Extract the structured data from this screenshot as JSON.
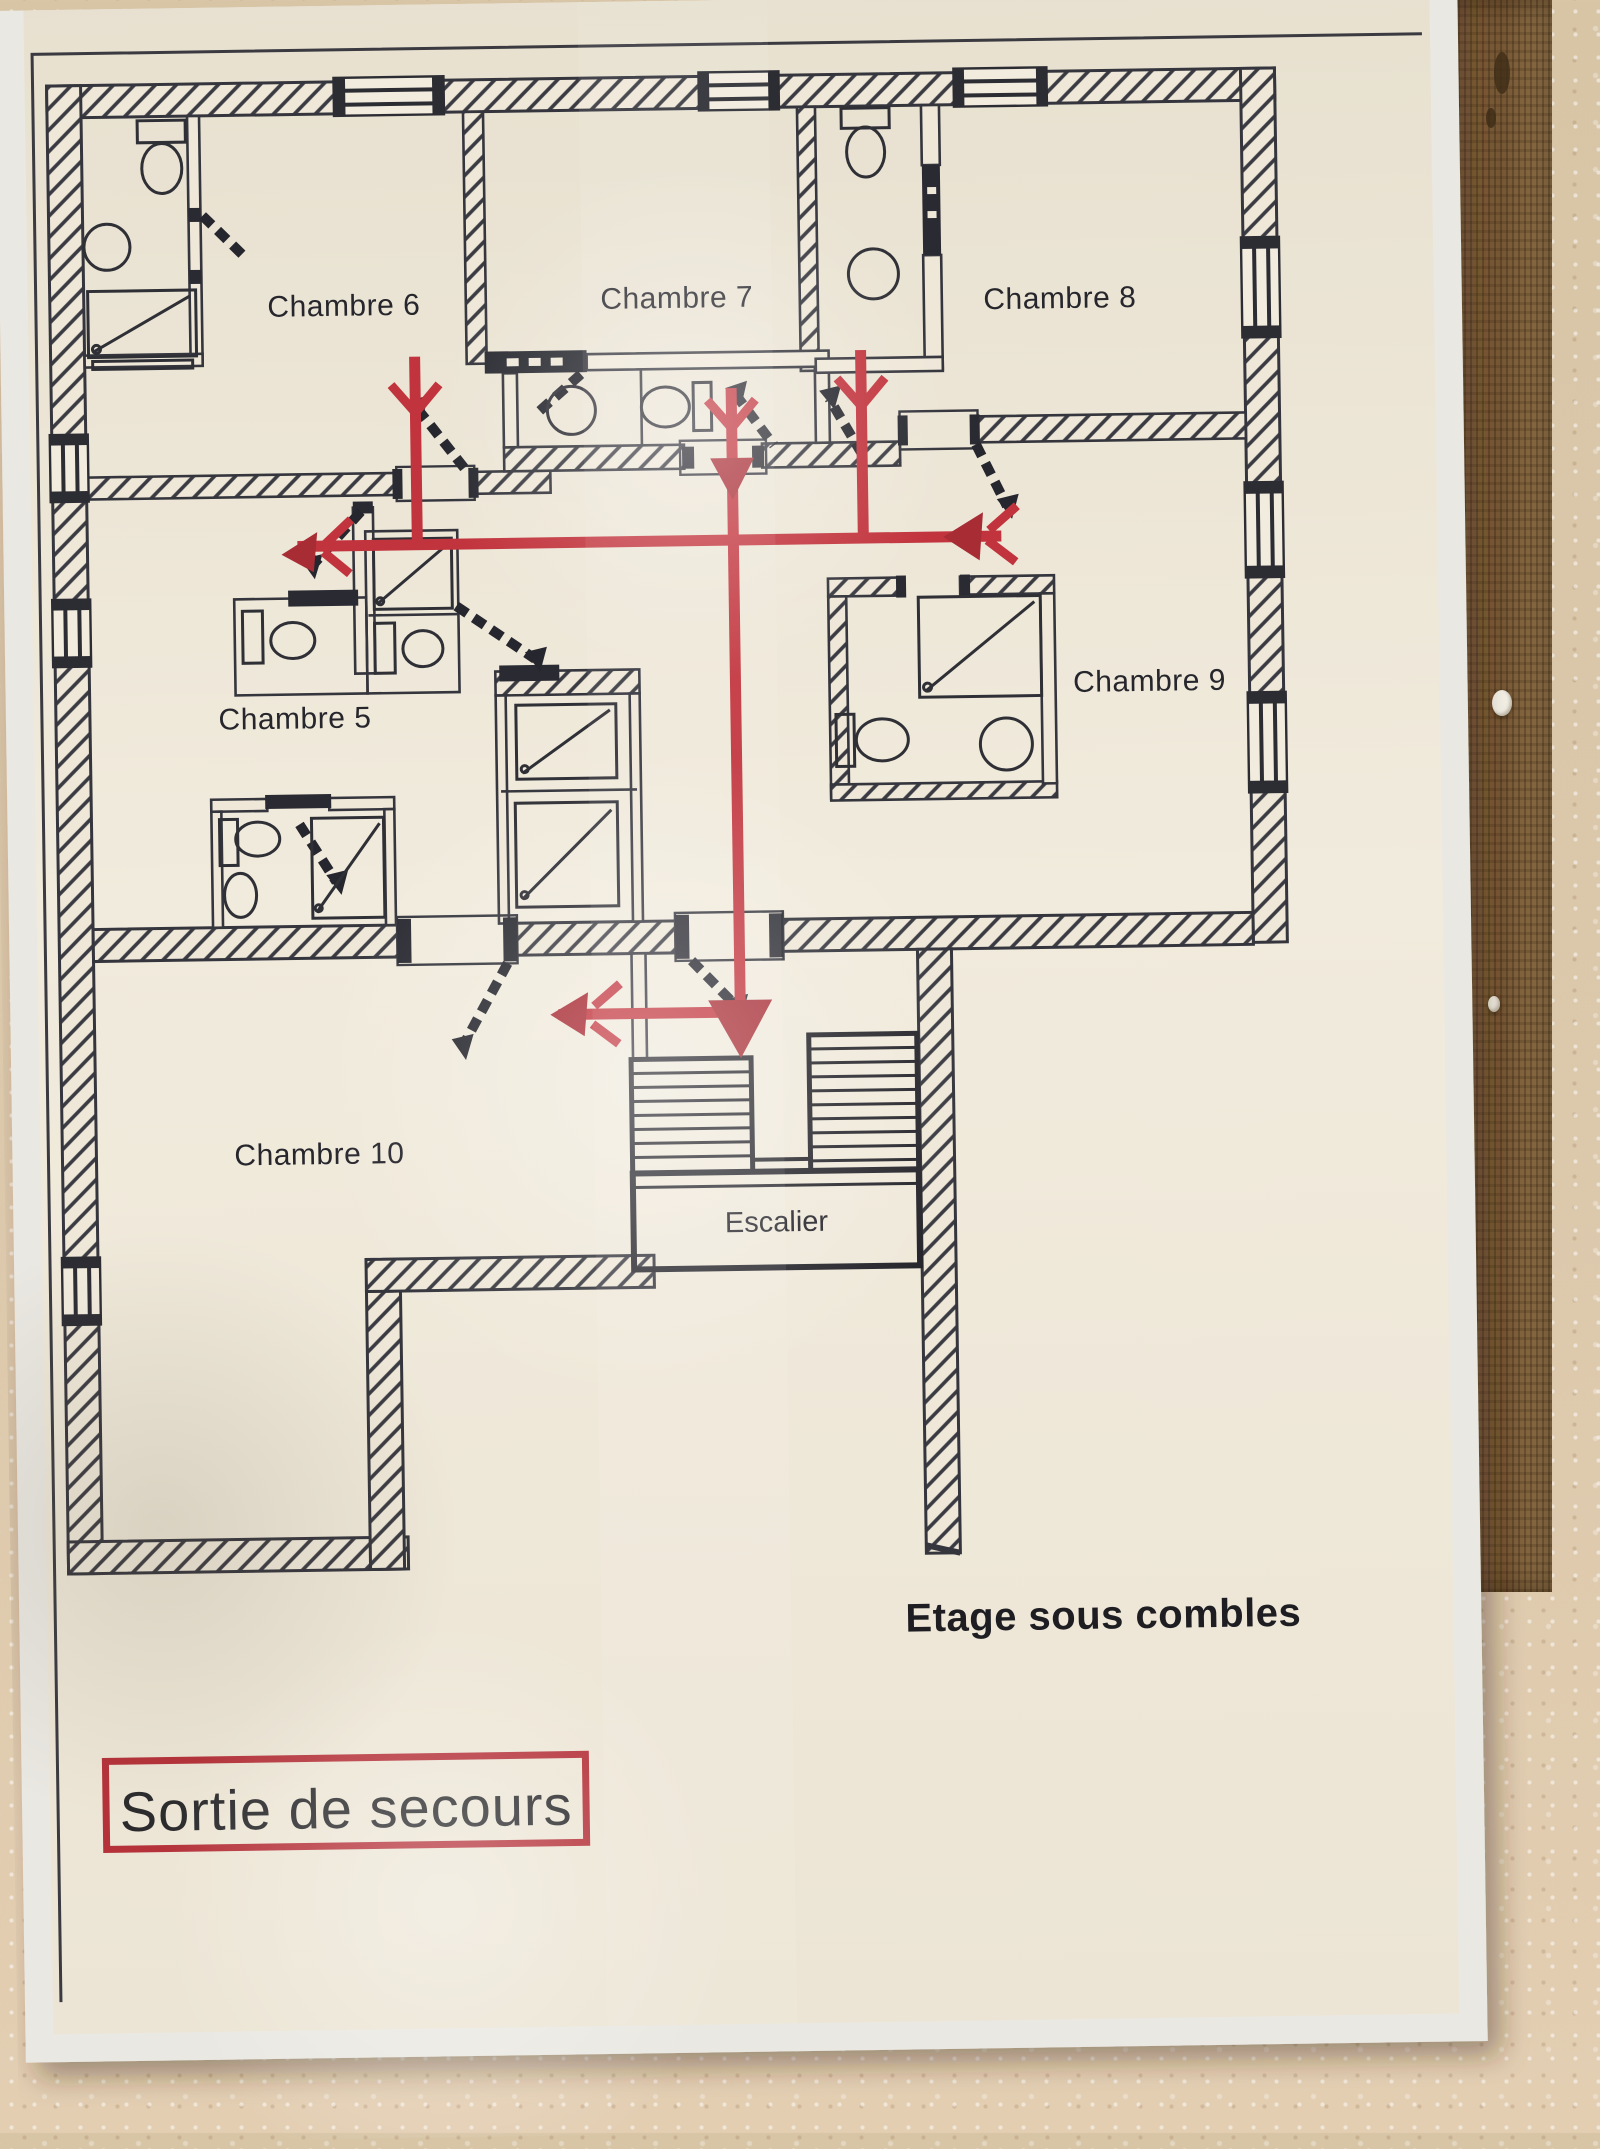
{
  "poster": {
    "rooms": [
      {
        "id": "chambre-6",
        "label": "Chambre 6"
      },
      {
        "id": "chambre-7",
        "label": "Chambre 7"
      },
      {
        "id": "chambre-8",
        "label": "Chambre 8"
      },
      {
        "id": "chambre-5",
        "label": "Chambre 5"
      },
      {
        "id": "chambre-9",
        "label": "Chambre 9"
      },
      {
        "id": "chambre-10",
        "label": "Chambre 10"
      }
    ],
    "stairs": {
      "label": "Escalier"
    },
    "captions": {
      "floor": "Etage sous combles"
    },
    "legend": {
      "label": "Sortie de secours"
    },
    "colors": {
      "escape_route": "#c2343d",
      "escape_route_dark": "#a82c34",
      "legend_border": "#b5323a",
      "ink": "#35353d",
      "paper": "#efe8d9",
      "cork": "#83623c",
      "wall_plaster": "#dbc7a9"
    }
  }
}
